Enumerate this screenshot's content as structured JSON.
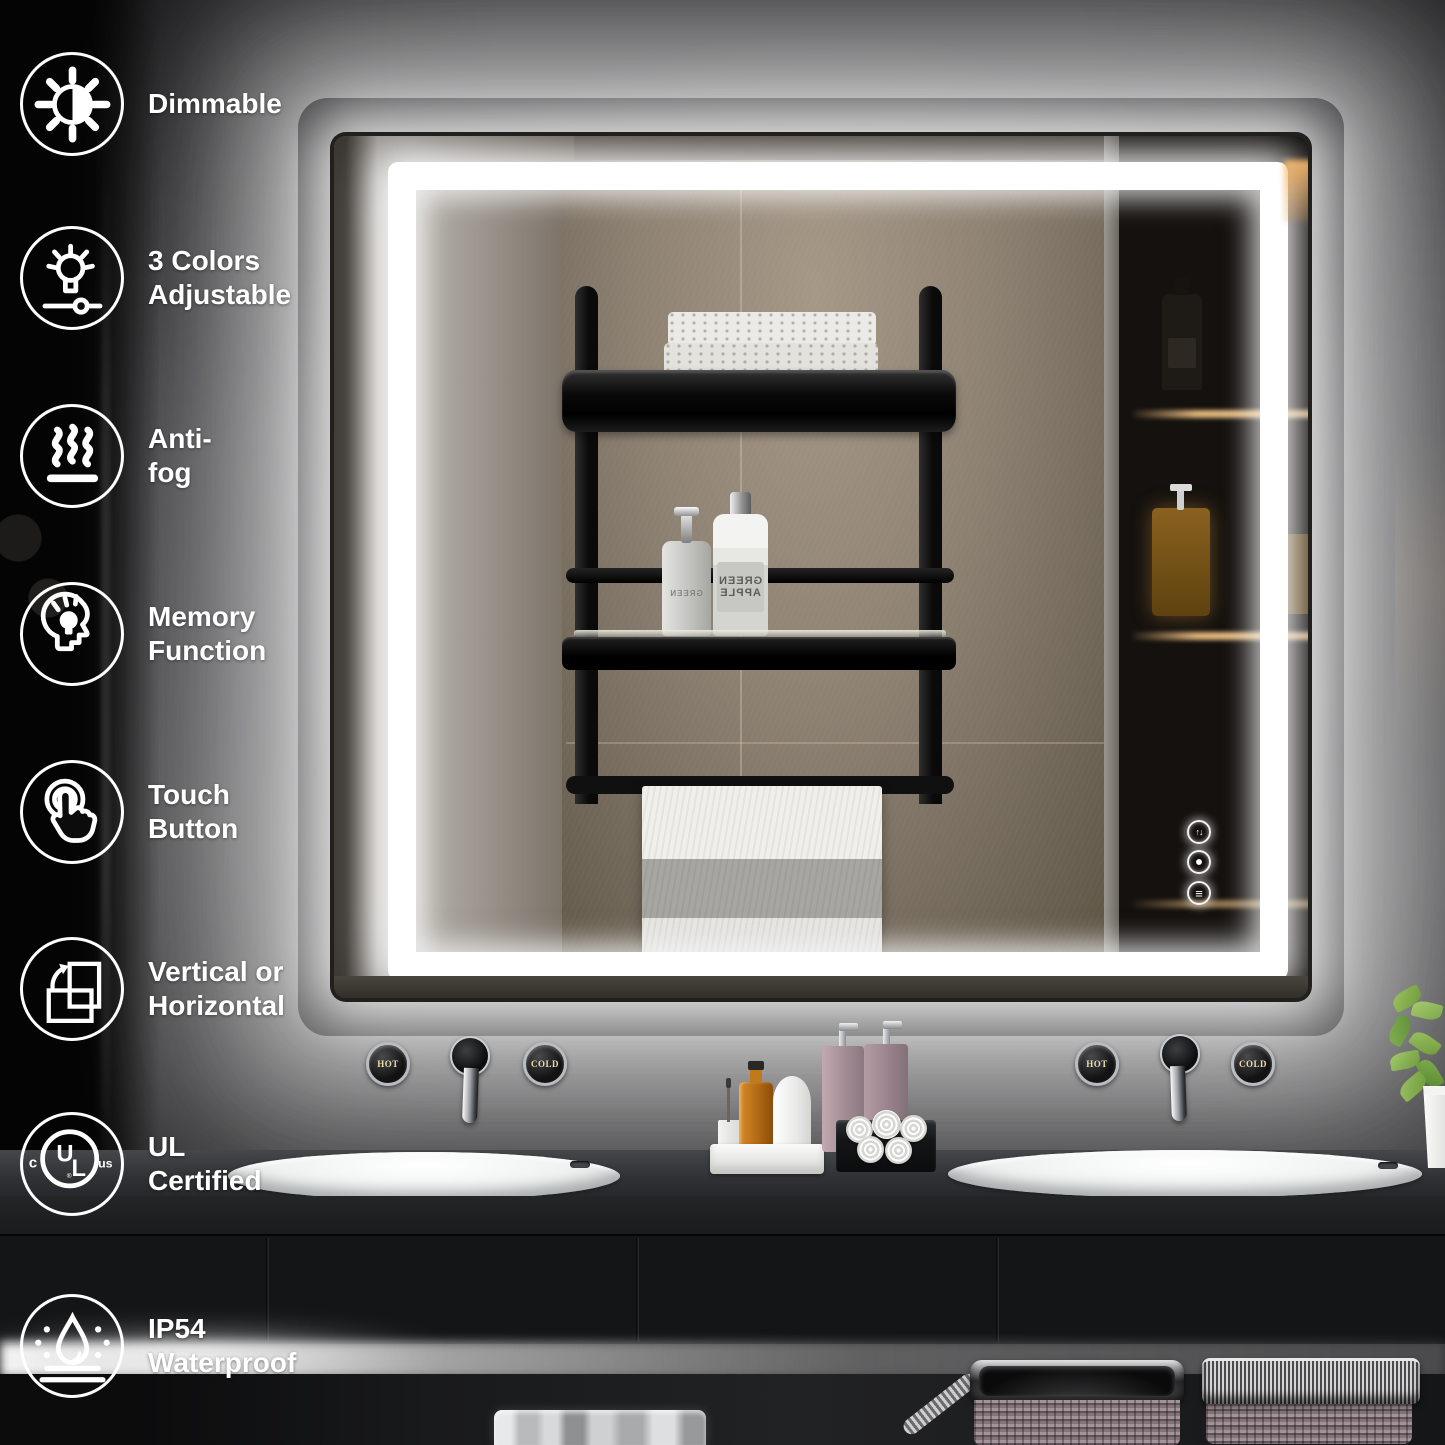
{
  "image_type": "led-bathroom-mirror-product-infographic",
  "features": {
    "items": [
      {
        "icon": "dimmable-sun-icon",
        "label": "Dimmable"
      },
      {
        "icon": "color-temperature-bulb-icon",
        "label": "3 Colors\nAdjustable"
      },
      {
        "icon": "anti-fog-steam-icon",
        "label": "Anti-fog"
      },
      {
        "icon": "memory-function-head-icon",
        "label": "Memory\nFunction"
      },
      {
        "icon": "touch-button-hand-icon",
        "label": "Touch\nButton"
      },
      {
        "icon": "vertical-horizontal-rotate-icon",
        "label": "Vertical or\nHorizontal"
      },
      {
        "icon": "ul-certified-mark-icon",
        "label": "UL Certified"
      },
      {
        "icon": "ip54-waterproof-droplet-icon",
        "label": "IP54\nWaterproof"
      }
    ]
  },
  "ul_mark": {
    "u": "U",
    "l": "L",
    "prefix": "c",
    "suffix": "us",
    "registered": "®"
  },
  "mirror": {
    "touch_controls": {
      "defog_glyph": "↑↓",
      "brightness_glyph": "≡"
    },
    "reflection": {
      "shampoo_label": "GREEN\nAPPLE",
      "pump_label": "GREEN"
    }
  },
  "faucets": {
    "left_hot": "HOT",
    "left_cold": "COLD",
    "right_hot": "HOT",
    "right_cold": "COLD"
  },
  "palette": {
    "led_white": "#ffffff",
    "wall_gray": "#4b4b4e",
    "cabinet_black": "#141517",
    "warm_shelf_light": "#e8b06a"
  }
}
